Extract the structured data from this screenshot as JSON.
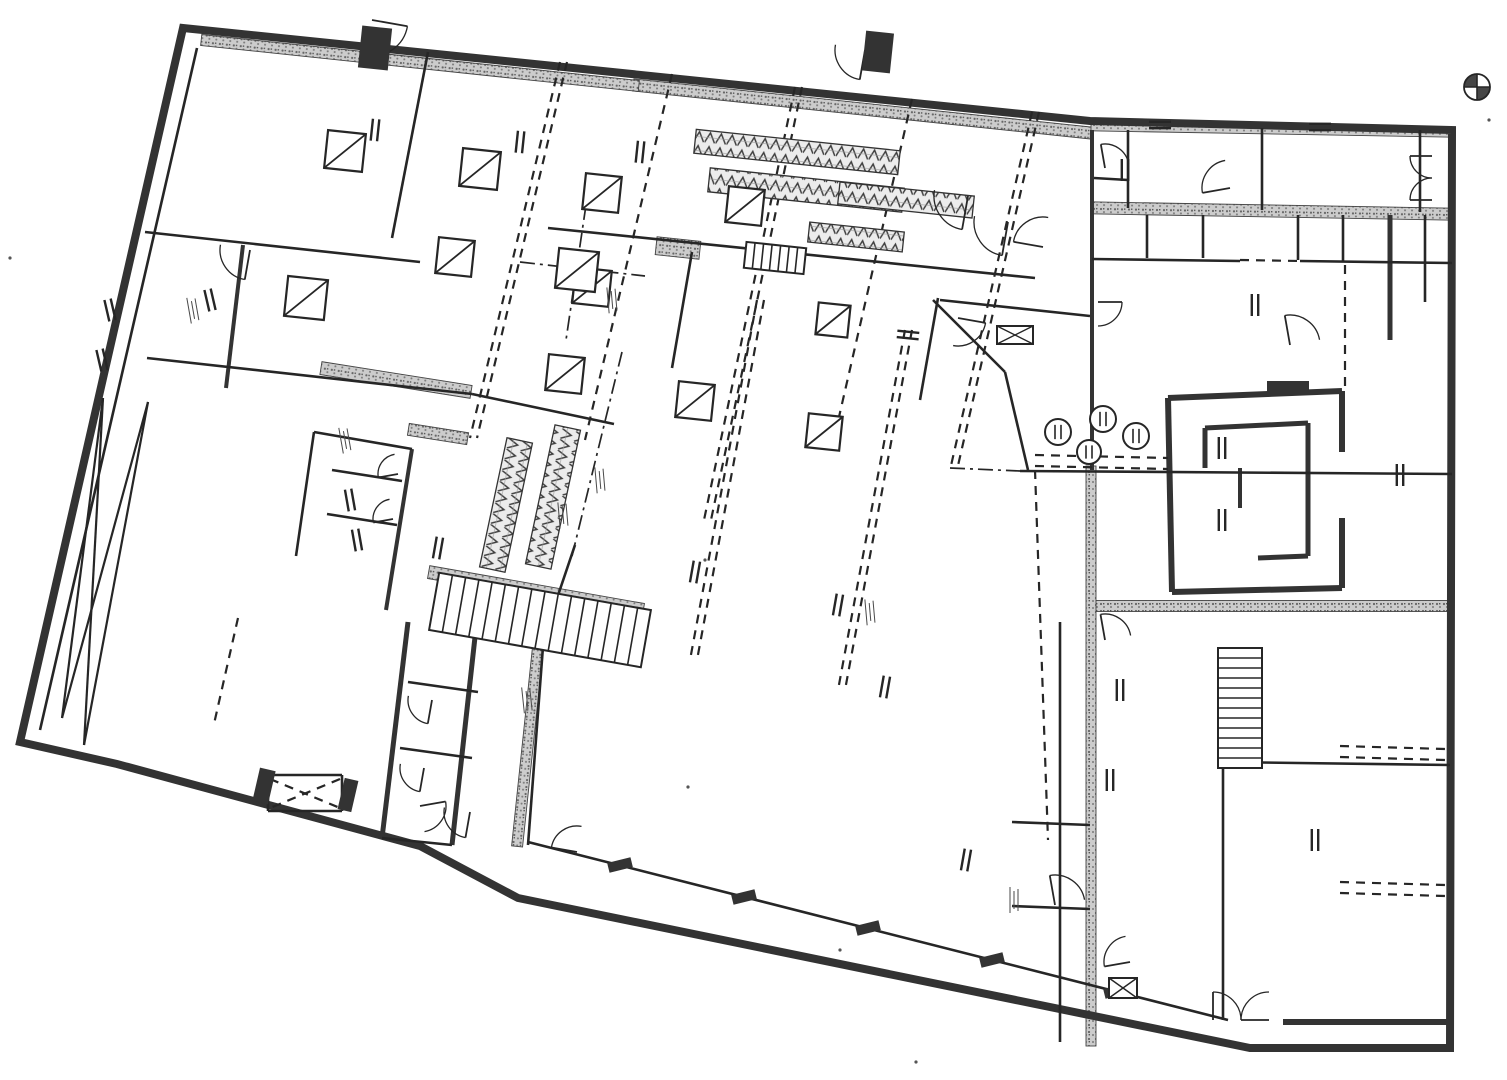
{
  "canvas": {
    "w": 1507,
    "h": 1080
  },
  "colors": {
    "paper": "#ffffff",
    "ink": "#262626",
    "heavy": "#333333",
    "band_bg": "#cccccc",
    "band_dot": "#666666",
    "zig_bg": "#ececec",
    "zig_ink": "#3d3d3d"
  },
  "plan": {
    "outline": [
      183,
      28,
      1090,
      121,
      1452,
      130,
      1450,
      1048,
      1250,
      1048,
      518,
      898,
      420,
      846,
      117,
      764,
      20,
      742
    ],
    "heavy": [
      [
        1283,
        1022,
        1450,
        1022,
        6
      ],
      [
        1168,
        398,
        1342,
        391,
        6
      ],
      [
        1342,
        391,
        1342,
        452,
        6
      ],
      [
        1342,
        518,
        1342,
        588,
        6
      ],
      [
        1342,
        588,
        1172,
        592,
        6
      ],
      [
        1172,
        592,
        1168,
        398,
        6
      ],
      [
        1205,
        428,
        1308,
        423,
        5
      ],
      [
        1308,
        423,
        1308,
        556,
        5
      ],
      [
        1308,
        556,
        1258,
        558,
        5
      ],
      [
        1205,
        428,
        1205,
        468,
        5
      ],
      [
        1240,
        468,
        1240,
        508,
        4
      ],
      [
        408,
        622,
        382,
        838,
        5
      ],
      [
        476,
        628,
        452,
        845,
        5
      ],
      [
        243,
        245,
        226,
        388,
        4
      ],
      [
        412,
        449,
        386,
        610,
        4
      ],
      [
        1390,
        215,
        1390,
        340,
        5
      ],
      [
        1092,
        130,
        1092,
        470,
        4
      ]
    ],
    "thin": [
      [
        197,
        48,
        40,
        730
      ],
      [
        145,
        232,
        420,
        262
      ],
      [
        428,
        52,
        392,
        238
      ],
      [
        147,
        358,
        472,
        394
      ],
      [
        472,
        394,
        614,
        424
      ],
      [
        314,
        432,
        296,
        556
      ],
      [
        314,
        432,
        412,
        449
      ],
      [
        332,
        470,
        402,
        481
      ],
      [
        327,
        514,
        397,
        525
      ],
      [
        548,
        228,
        1035,
        278
      ],
      [
        692,
        252,
        672,
        368
      ],
      [
        940,
        300,
        1090,
        316
      ],
      [
        938,
        298,
        920,
        400
      ],
      [
        933,
        300,
        1005,
        372
      ],
      [
        1005,
        372,
        1028,
        470
      ],
      [
        528,
        842,
        1228,
        1020
      ],
      [
        545,
        620,
        528,
        845
      ],
      [
        575,
        545,
        548,
        625
      ],
      [
        408,
        682,
        478,
        692
      ],
      [
        400,
        748,
        472,
        758
      ],
      [
        1128,
        130,
        1128,
        208
      ],
      [
        1262,
        128,
        1262,
        210
      ],
      [
        1420,
        130,
        1420,
        212
      ],
      [
        1094,
        178,
        1128,
        180
      ],
      [
        1092,
        259,
        1240,
        261
      ],
      [
        1300,
        261,
        1452,
        263
      ],
      [
        1147,
        215,
        1147,
        258
      ],
      [
        1203,
        215,
        1203,
        258
      ],
      [
        1298,
        215,
        1298,
        260
      ],
      [
        1343,
        215,
        1343,
        262
      ],
      [
        1020,
        471,
        1452,
        474
      ],
      [
        1425,
        215,
        1425,
        302
      ],
      [
        1223,
        762,
        1450,
        765
      ],
      [
        1223,
        765,
        1223,
        1020
      ],
      [
        1060,
        622,
        1060,
        1042
      ],
      [
        1012,
        822,
        1090,
        825
      ],
      [
        1012,
        906,
        1090,
        909
      ],
      [
        382,
        838,
        452,
        845
      ],
      [
        268,
        775,
        342,
        775
      ],
      [
        268,
        775,
        268,
        811
      ],
      [
        268,
        811,
        342,
        811
      ],
      [
        342,
        775,
        342,
        811
      ]
    ],
    "dashed": [
      [
        560,
        62,
        470,
        438
      ],
      [
        567,
        62,
        477,
        438
      ],
      [
        672,
        74,
        585,
        440
      ],
      [
        795,
        87,
        704,
        520
      ],
      [
        802,
        87,
        711,
        520
      ],
      [
        912,
        99,
        836,
        430
      ],
      [
        1032,
        112,
        950,
        470
      ],
      [
        1039,
        112,
        957,
        470
      ],
      [
        757,
        300,
        690,
        660
      ],
      [
        764,
        300,
        697,
        660
      ],
      [
        905,
        330,
        838,
        690
      ],
      [
        912,
        330,
        845,
        690
      ],
      [
        238,
        618,
        214,
        724
      ],
      [
        1345,
        265,
        1345,
        392
      ],
      [
        1340,
        746,
        1445,
        749
      ],
      [
        1340,
        757,
        1445,
        760
      ],
      [
        1340,
        882,
        1445,
        885
      ],
      [
        1340,
        893,
        1445,
        896
      ],
      [
        1035,
        455,
        1168,
        458
      ],
      [
        1035,
        466,
        1168,
        469
      ],
      [
        1240,
        260,
        1300,
        261
      ],
      [
        1035,
        470,
        1048,
        840
      ],
      [
        270,
        779,
        340,
        808
      ],
      [
        340,
        779,
        270,
        808
      ]
    ],
    "dashdot": [
      [
        520,
        262,
        645,
        276
      ],
      [
        586,
        205,
        566,
        340
      ],
      [
        622,
        352,
        572,
        556
      ],
      [
        950,
        468,
        1020,
        471
      ]
    ],
    "xbrace": [
      [
        103,
        398,
        62,
        718
      ],
      [
        148,
        402,
        84,
        745
      ],
      [
        148,
        402,
        62,
        718
      ],
      [
        103,
        398,
        84,
        745
      ]
    ],
    "bands": [
      [
        396,
        380,
        152,
        13,
        9
      ],
      [
        438,
        434,
        60,
        12,
        9
      ],
      [
        1272,
        211,
        362,
        12,
        1
      ],
      [
        1272,
        606,
        362,
        11,
        0
      ],
      [
        1091,
        756,
        580,
        10,
        90
      ],
      [
        529,
        733,
        228,
        11,
        96
      ],
      [
        862,
        109,
        460,
        12,
        6
      ],
      [
        420,
        63,
        440,
        11,
        6
      ],
      [
        1272,
        129,
        362,
        10,
        1
      ],
      [
        536,
        591,
        218,
        13,
        10
      ],
      [
        678,
        248,
        44,
        18,
        6
      ]
    ],
    "ramps": [
      [
        797,
        152,
        205,
        24,
        6
      ],
      [
        806,
        190,
        195,
        24,
        6
      ],
      [
        906,
        200,
        135,
        22,
        6
      ],
      [
        856,
        237,
        95,
        20,
        6
      ],
      [
        506,
        505,
        132,
        26,
        102
      ],
      [
        553,
        497,
        142,
        26,
        102
      ]
    ],
    "stairs": [
      [
        540,
        620,
        215,
        58,
        10,
        15
      ],
      [
        1240,
        708,
        120,
        44,
        90,
        11
      ],
      [
        775,
        258,
        60,
        26,
        6,
        6
      ]
    ],
    "columns": [
      [
        345,
        151,
        38
      ],
      [
        480,
        169,
        38
      ],
      [
        602,
        193,
        36
      ],
      [
        745,
        206,
        36
      ],
      [
        455,
        257,
        36
      ],
      [
        592,
        287,
        36
      ],
      [
        306,
        298,
        40
      ],
      [
        577,
        270,
        40
      ],
      [
        565,
        374,
        36
      ],
      [
        695,
        401,
        36
      ],
      [
        824,
        432,
        34
      ],
      [
        833,
        320,
        32
      ]
    ],
    "rounds": [
      [
        1058,
        432,
        13
      ],
      [
        1103,
        419,
        13
      ],
      [
        1136,
        436,
        13
      ],
      [
        1089,
        452,
        12
      ]
    ],
    "doors": [
      [
        372,
        20,
        36,
        10,
        1
      ],
      [
        865,
        50,
        30,
        100,
        1
      ],
      [
        250,
        250,
        30,
        100,
        1
      ],
      [
        968,
        196,
        34,
        100,
        1
      ],
      [
        1008,
        222,
        34,
        100,
        1
      ],
      [
        1043,
        247,
        30,
        190,
        1
      ],
      [
        958,
        318,
        28,
        10,
        1
      ],
      [
        398,
        474,
        20,
        170,
        1
      ],
      [
        393,
        519,
        20,
        170,
        1
      ],
      [
        432,
        700,
        24,
        100,
        1
      ],
      [
        424,
        768,
        24,
        100,
        1
      ],
      [
        420,
        806,
        26,
        -10,
        1
      ],
      [
        470,
        812,
        26,
        100,
        1
      ],
      [
        1105,
        168,
        24,
        260,
        1
      ],
      [
        1230,
        188,
        28,
        170,
        1
      ],
      [
        1098,
        302,
        24,
        0,
        1
      ],
      [
        1105,
        640,
        26,
        260,
        1
      ],
      [
        1055,
        905,
        30,
        260,
        1
      ],
      [
        1130,
        962,
        26,
        170,
        1
      ],
      [
        1213,
        1020,
        28,
        270,
        1
      ],
      [
        1269,
        1020,
        28,
        180,
        1
      ],
      [
        1432,
        156,
        22,
        180,
        -1
      ],
      [
        1432,
        200,
        22,
        180,
        1
      ],
      [
        577,
        852,
        26,
        190,
        1
      ],
      [
        1290,
        345,
        30,
        260,
        1
      ]
    ],
    "marks": [
      [
        110,
        310,
        -103
      ],
      [
        102,
        360,
        -103
      ],
      [
        210,
        300,
        -103
      ],
      [
        375,
        130,
        96
      ],
      [
        520,
        142,
        96
      ],
      [
        640,
        152,
        96
      ],
      [
        438,
        548,
        100
      ],
      [
        695,
        572,
        100
      ],
      [
        838,
        605,
        100
      ],
      [
        885,
        687,
        100
      ],
      [
        966,
        860,
        100
      ],
      [
        1255,
        305,
        90
      ],
      [
        1222,
        448,
        90
      ],
      [
        1222,
        520,
        90
      ],
      [
        1110,
        780,
        90
      ],
      [
        1400,
        475,
        90
      ],
      [
        1315,
        840,
        90
      ],
      [
        1120,
        690,
        90
      ],
      [
        350,
        500,
        -100
      ],
      [
        357,
        540,
        -100
      ],
      [
        908,
        335,
        6
      ],
      [
        1160,
        125,
        0
      ],
      [
        1320,
        127,
        0
      ],
      [
        1125,
        170,
        90
      ]
    ],
    "notes": [
      [
        193,
        310,
        -100
      ],
      [
        600,
        480,
        -95
      ],
      [
        345,
        440,
        -100
      ],
      [
        870,
        612,
        -95
      ],
      [
        1014,
        900,
        -90
      ],
      [
        612,
        300,
        -95
      ],
      [
        563,
        515,
        -95
      ],
      [
        527,
        700,
        -96
      ]
    ],
    "piers": [
      [
        375,
        48,
        30,
        42,
        6
      ],
      [
        878,
        52,
        28,
        40,
        6
      ],
      [
        620,
        865,
        10,
        24,
        76
      ],
      [
        744,
        897,
        10,
        24,
        76
      ],
      [
        868,
        928,
        10,
        24,
        76
      ],
      [
        992,
        960,
        10,
        24,
        76
      ],
      [
        1116,
        991,
        10,
        24,
        76
      ],
      [
        264,
        786,
        16,
        34,
        13
      ],
      [
        348,
        795,
        14,
        32,
        13
      ],
      [
        1288,
        387,
        42,
        12,
        0
      ]
    ],
    "boxx": [
      [
        1123,
        988,
        28,
        20
      ],
      [
        1015,
        335,
        36,
        18
      ]
    ],
    "speckles": [
      [
        10,
        258
      ],
      [
        688,
        787
      ],
      [
        916,
        1062
      ],
      [
        1489,
        120
      ],
      [
        840,
        950
      ],
      [
        705,
        560
      ]
    ],
    "north": [
      1477,
      87,
      13
    ]
  }
}
